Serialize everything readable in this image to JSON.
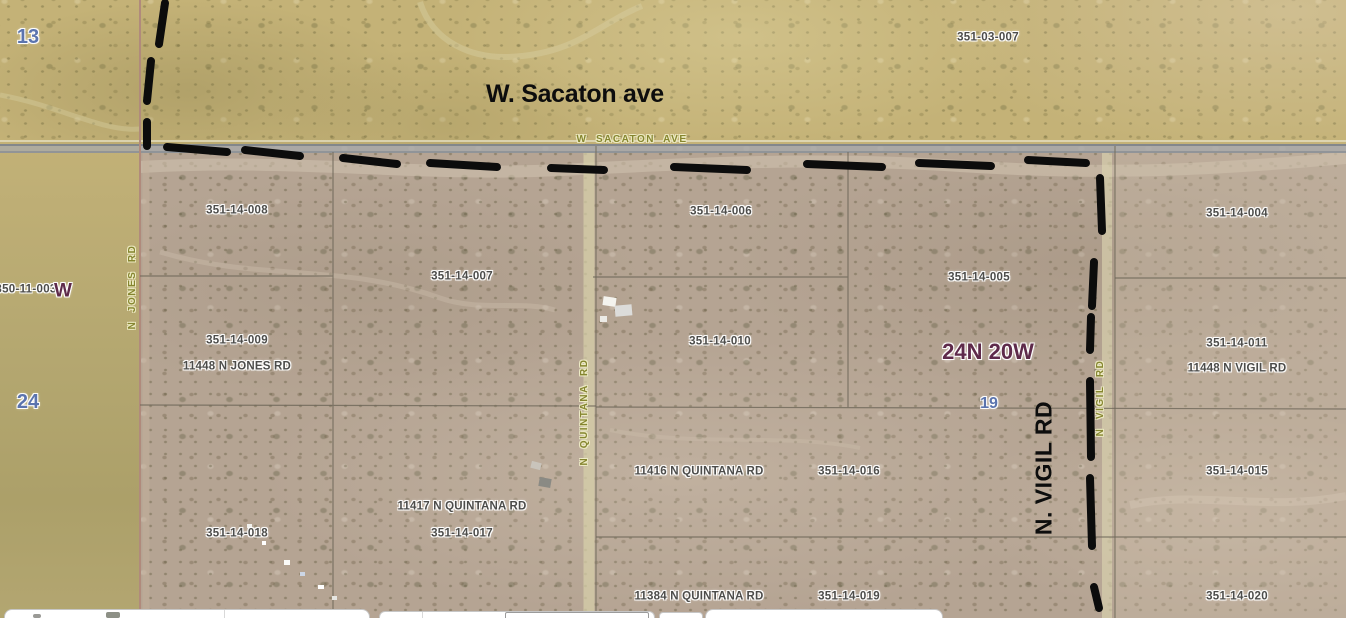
{
  "map": {
    "annotations": {
      "sacaton": "W. Sacaton ave",
      "vigil": "N. VIGIL RD"
    },
    "labels": [
      {
        "text": "351-03-007",
        "x": 988,
        "y": 38,
        "cls": "parcel"
      },
      {
        "text": "350-11-003",
        "x": 26,
        "y": 290,
        "cls": "parcel"
      },
      {
        "text": "351-14-008",
        "x": 237,
        "y": 211,
        "cls": "parcel"
      },
      {
        "text": "351-14-006",
        "x": 721,
        "y": 212,
        "cls": "parcel"
      },
      {
        "text": "351-14-004",
        "x": 1237,
        "y": 214,
        "cls": "parcel"
      },
      {
        "text": "351-14-007",
        "x": 462,
        "y": 277,
        "cls": "parcel"
      },
      {
        "text": "351-14-005",
        "x": 979,
        "y": 278,
        "cls": "parcel"
      },
      {
        "text": "351-14-009",
        "x": 237,
        "y": 341,
        "cls": "parcel"
      },
      {
        "text": "351-14-010",
        "x": 720,
        "y": 342,
        "cls": "parcel"
      },
      {
        "text": "351-14-011",
        "x": 1237,
        "y": 344,
        "cls": "parcel"
      },
      {
        "text": "351-14-018",
        "x": 237,
        "y": 534,
        "cls": "parcel"
      },
      {
        "text": "351-14-017",
        "x": 462,
        "y": 534,
        "cls": "parcel"
      },
      {
        "text": "351-14-016",
        "x": 849,
        "y": 472,
        "cls": "parcel"
      },
      {
        "text": "351-14-015",
        "x": 1237,
        "y": 472,
        "cls": "parcel"
      },
      {
        "text": "351-14-019",
        "x": 849,
        "y": 597,
        "cls": "parcel"
      },
      {
        "text": "351-14-020",
        "x": 1237,
        "y": 597,
        "cls": "parcel"
      },
      {
        "text": "11448 N JONES RD",
        "x": 237,
        "y": 367,
        "cls": "address"
      },
      {
        "text": "11448 N VIGIL RD",
        "x": 1237,
        "y": 369,
        "cls": "address"
      },
      {
        "text": "11417 N QUINTANA RD",
        "x": 462,
        "y": 507,
        "cls": "address"
      },
      {
        "text": "11416 N QUINTANA RD",
        "x": 699,
        "y": 472,
        "cls": "address"
      },
      {
        "text": "11384 N QUINTANA RD",
        "x": 699,
        "y": 597,
        "cls": "address"
      },
      {
        "text": "13",
        "x": 28,
        "y": 37,
        "cls": "section"
      },
      {
        "text": "24",
        "x": 28,
        "y": 402,
        "cls": "section"
      },
      {
        "text": "19",
        "x": 989,
        "y": 404,
        "cls": "section-sm"
      },
      {
        "text": "24N 20W",
        "x": 988,
        "y": 352,
        "cls": "township"
      },
      {
        "text": "W",
        "x": 63,
        "y": 291,
        "cls": "township-sm"
      },
      {
        "text": "W  SACATON  AVE",
        "x": 632,
        "y": 140,
        "cls": "roadlbl"
      },
      {
        "text": "N  JONES  RD",
        "x": 133,
        "y": 287,
        "cls": "roadlbl rot"
      },
      {
        "text": "N  QUINTANA  RD",
        "x": 585,
        "y": 412,
        "cls": "roadlbl rot"
      },
      {
        "text": "N  VIGIL  RD",
        "x": 1101,
        "y": 398,
        "cls": "roadlbl rot"
      }
    ],
    "colors": {
      "terrain_olive": "#c4b277",
      "terrain_brown": "#b5a493",
      "parcel_label": "#4c4c4a",
      "section_number": "#5b74ae",
      "township_label": "#5e2a4a",
      "road_label": "#85852f",
      "annotation_ink": "#0d0d0d"
    }
  }
}
